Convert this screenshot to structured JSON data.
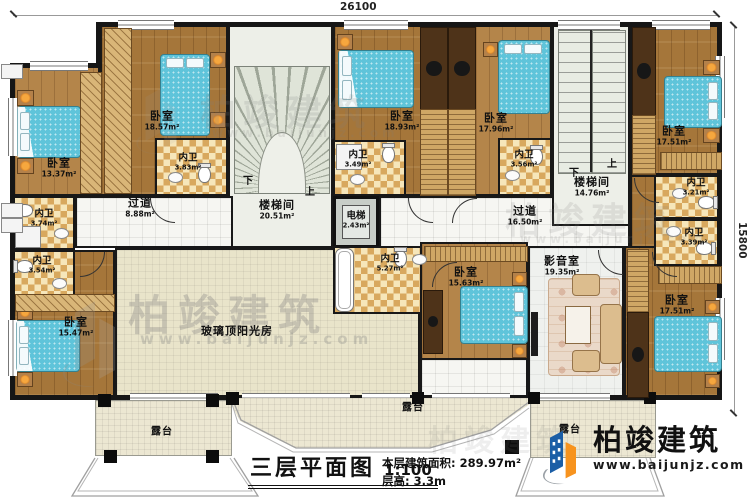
{
  "dims": {
    "w": "26100",
    "h": "15800"
  },
  "rooms": {
    "btl1": {
      "name": "卧室",
      "area": "13.37m²"
    },
    "btl2": {
      "name": "卧室",
      "area": "18.57m²"
    },
    "bath383": {
      "name": "内卫",
      "area": "3.83m²"
    },
    "bath374": {
      "name": "内卫",
      "area": "3.74m²"
    },
    "bath354": {
      "name": "内卫",
      "area": "3.54m²"
    },
    "bbl": {
      "name": "卧室",
      "area": "15.47m²"
    },
    "corr_l": {
      "name": "过道",
      "area": "8.88m²"
    },
    "stair_l": {
      "name": "楼梯间",
      "area": "20.51m²"
    },
    "elev": {
      "name": "电梯",
      "area": "2.43m²"
    },
    "bath349": {
      "name": "内卫",
      "area": "3.49m²"
    },
    "bm1": {
      "name": "卧室",
      "area": "18.93m²"
    },
    "bm2": {
      "name": "卧室",
      "area": "17.96m²"
    },
    "bath356": {
      "name": "内卫",
      "area": "3.56m²"
    },
    "stair_r": {
      "name": "楼梯间",
      "area": "14.76m²"
    },
    "corr_r": {
      "name": "过道",
      "area": "16.50m²"
    },
    "btr": {
      "name": "卧室",
      "area": "17.51m²"
    },
    "bath321": {
      "name": "内卫",
      "area": "3.21m²"
    },
    "bath339": {
      "name": "内卫",
      "area": "3.39m²"
    },
    "bath527": {
      "name": "内卫",
      "area": "5.27m²"
    },
    "bbm": {
      "name": "卧室",
      "area": "15.63m²"
    },
    "media": {
      "name": "影音室",
      "area": "19.35m²"
    },
    "bbr": {
      "name": "卧室",
      "area": "17.51m²"
    },
    "sunroom": {
      "name": "玻璃顶阳光房"
    },
    "ter_l": {
      "name": "露台"
    },
    "ter_m": {
      "name": "露台"
    },
    "ter_r": {
      "name": "露台"
    }
  },
  "stairs": {
    "down": "下",
    "up": "上"
  },
  "title": {
    "main": "三层平面图",
    "scale": "1:100",
    "area": "本层建筑面积: 289.97m²",
    "floor": "层高: 3.3m"
  },
  "logo": {
    "name": "柏竣建筑",
    "url": "www.baijunjz.com"
  },
  "watermark": {
    "text": "柏竣建筑",
    "url": "www.baijunjz.com"
  },
  "colors": {
    "wall": "#161616",
    "wood": "#a5763a",
    "bath_floor": "#e8c27c",
    "bed": "#5fc4da",
    "brand_blue": "#1b5ea6",
    "brand_orange": "#f7931e"
  }
}
